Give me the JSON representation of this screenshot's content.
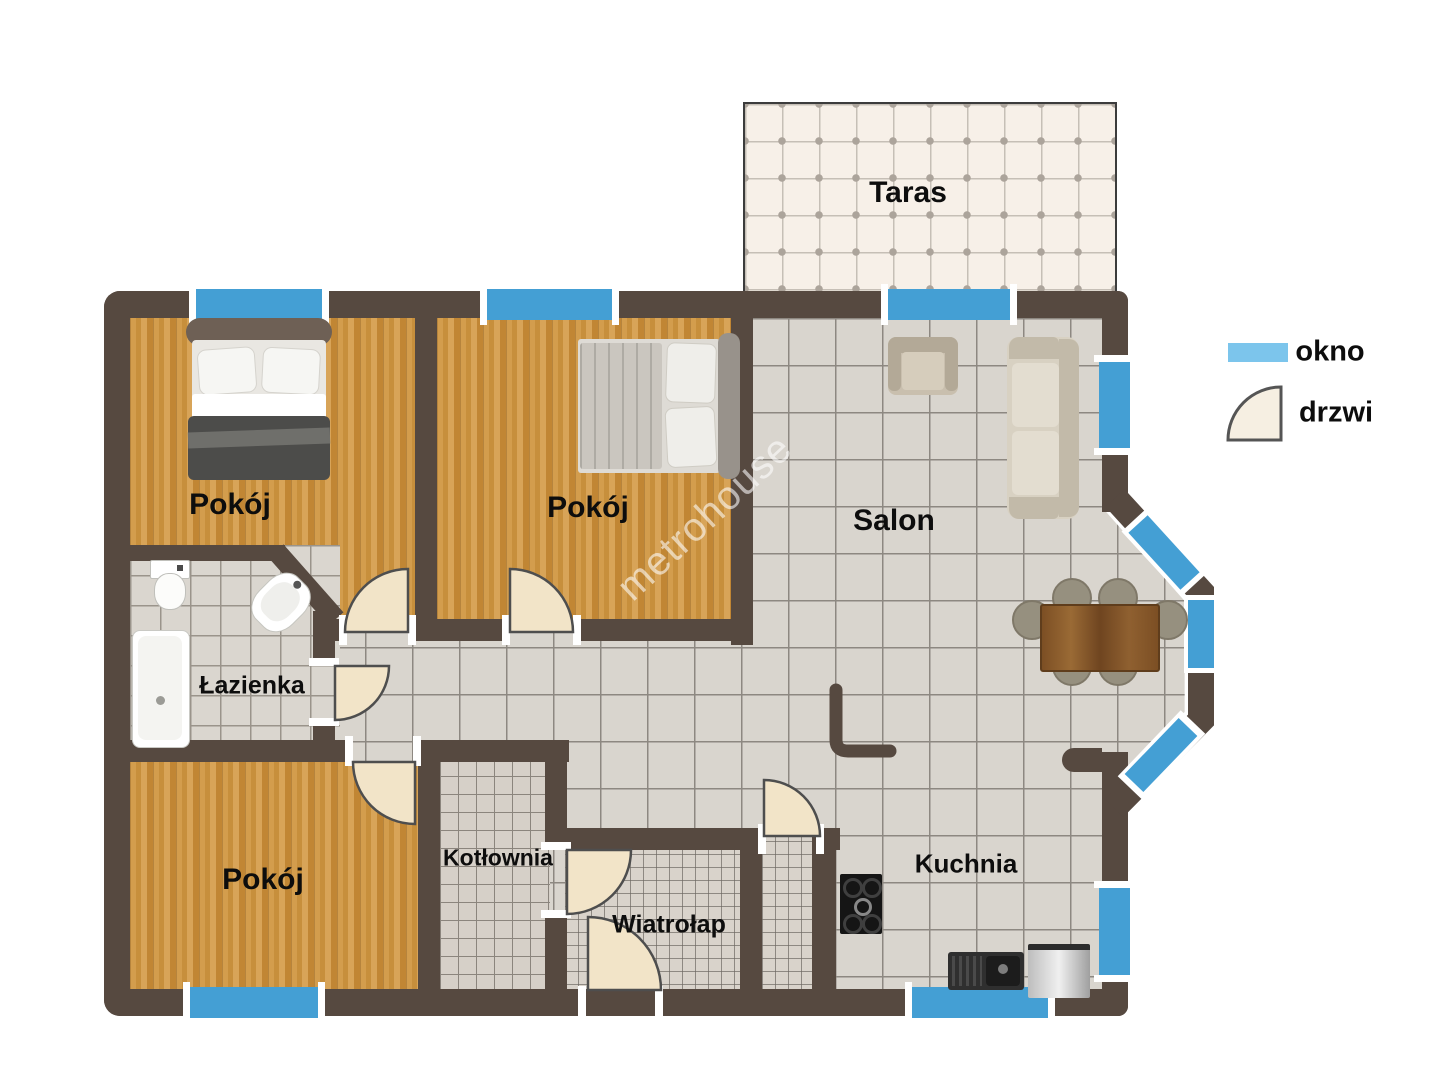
{
  "floorplan": {
    "watermark": "metrohouse",
    "rooms": {
      "taras": "Taras",
      "pokoj_top_left": "Pokój",
      "pokoj_top_middle": "Pokój",
      "salon": "Salon",
      "lazienka": "Łazienka",
      "pokoj_bottom_left": "Pokój",
      "kotlownia": "Kotłownia",
      "wiatrolap": "Wiatrołap",
      "kuchnia": "Kuchnia"
    },
    "legend": {
      "window": "okno",
      "door": "drzwi"
    },
    "colors": {
      "wall": "#564940",
      "window_blue": "#449fd4",
      "legend_window_blue": "#7cc5ec",
      "door_fill": "#f2e4c8",
      "wood_floor": "#cc9545",
      "tile_floor": "#d9d5ce",
      "terrace_tile": "#f7f0e8"
    }
  }
}
